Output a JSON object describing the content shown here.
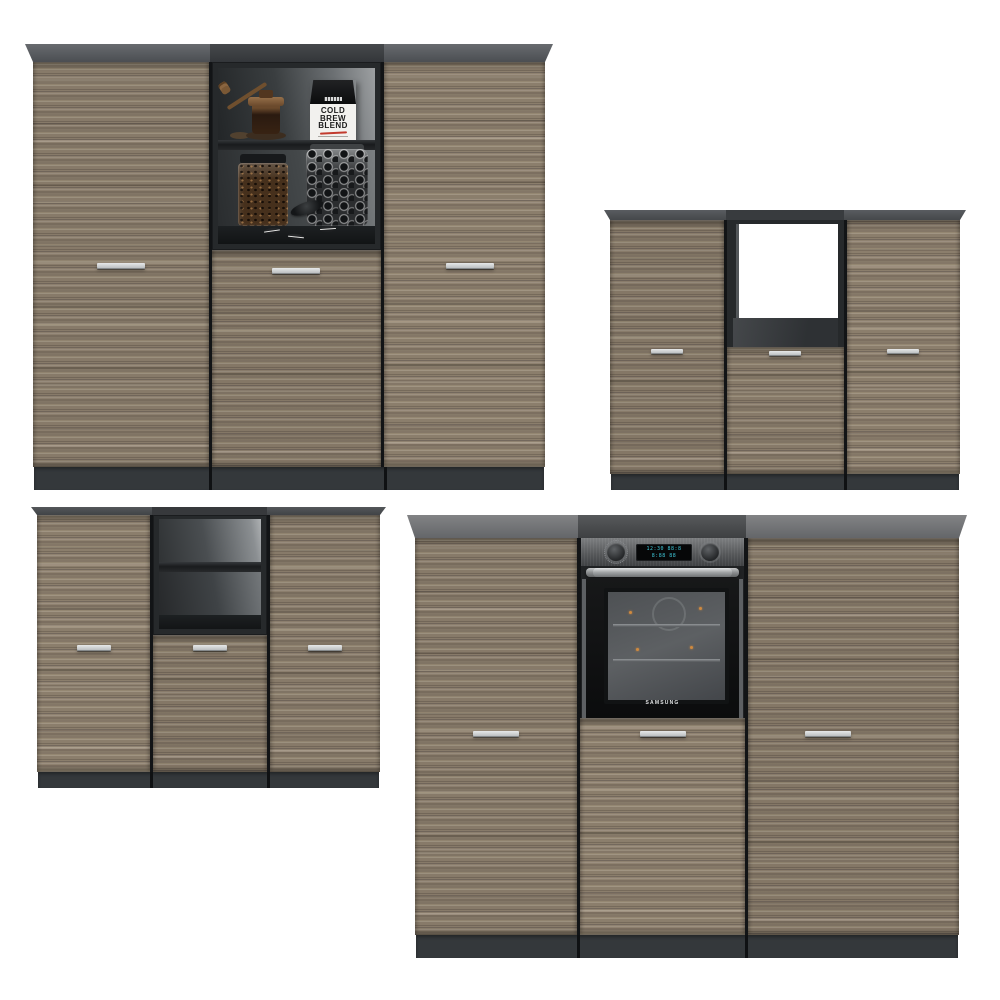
{
  "palette": {
    "bg": "#ffffff",
    "plinth": "#34383b",
    "frame": "#26292b",
    "handle-1": "#e6e8e9",
    "handle-2": "#b4b7b9",
    "handle-edge": "#85898b",
    "display-cyan": "#3fc9da",
    "label-red": "#c23b2e",
    "wood-base": "#87796a",
    "top-gray-light": "#828385",
    "top-gray-dark": "#46494c"
  },
  "decor": {
    "coffee_bag": {
      "line1": "COLD",
      "line2": "BREW",
      "line3": "BLEND"
    }
  },
  "oven": {
    "brand": "SAMSUNG",
    "display": {
      "row1": "12:30 88:8",
      "row2": "8:88 88"
    }
  }
}
